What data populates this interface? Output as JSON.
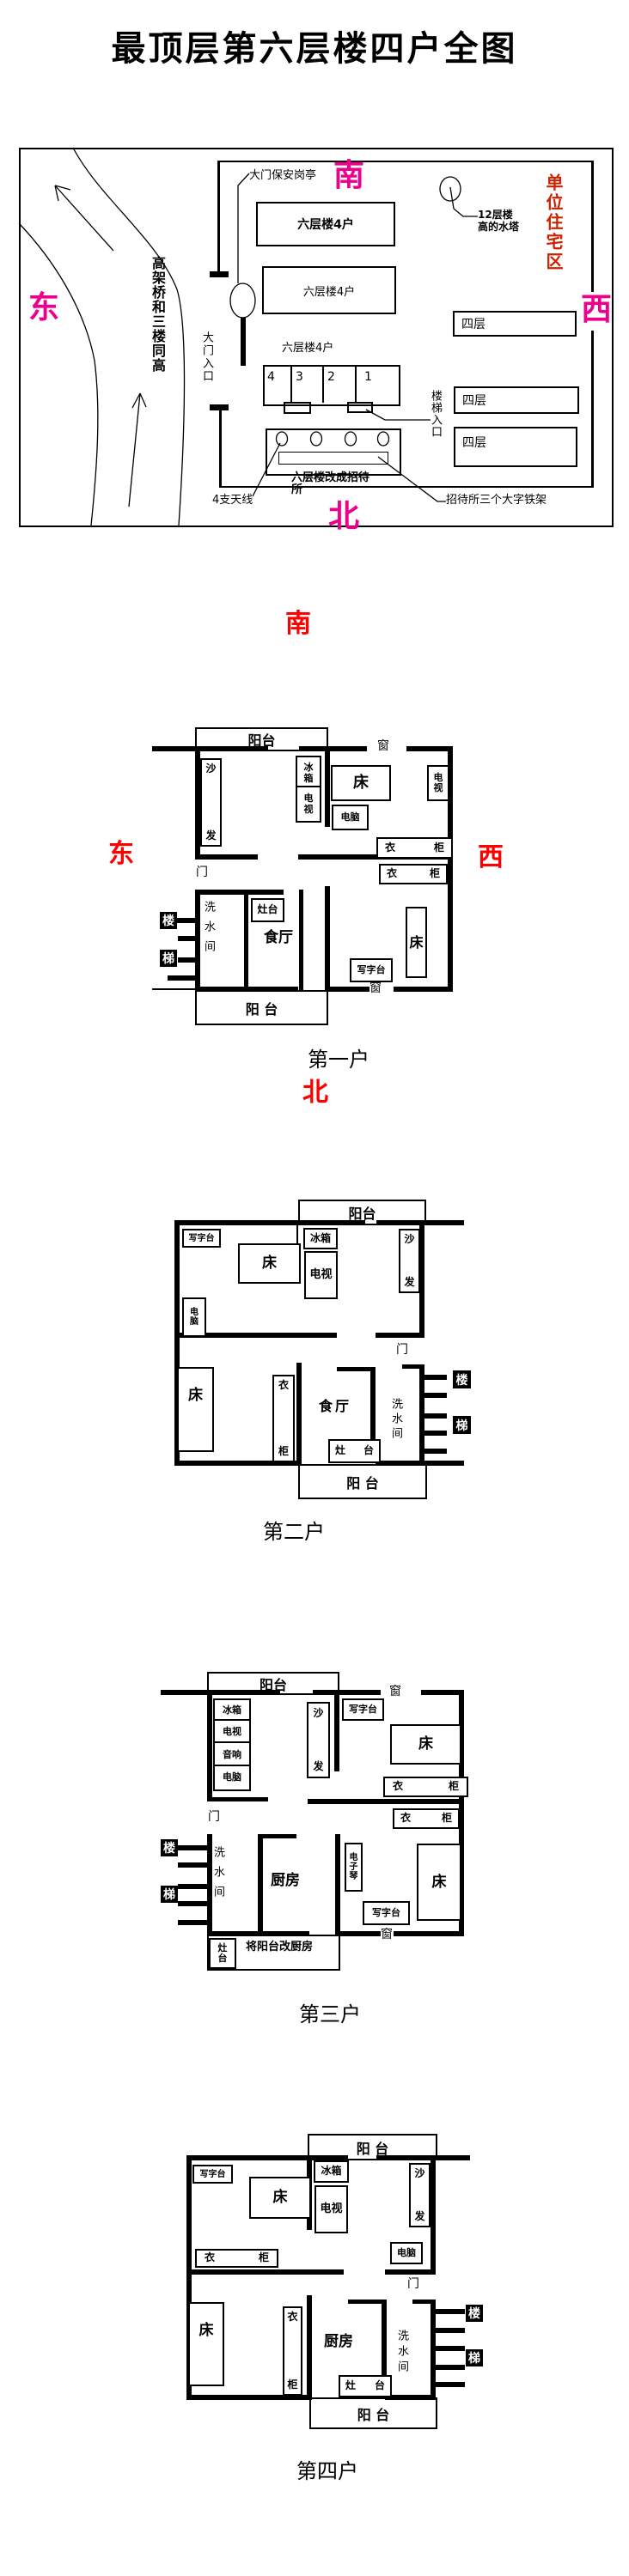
{
  "title": "最顶层第六层楼四户全图",
  "colors": {
    "map_compass": "#ec008c",
    "residential_zone_red": "#cc2200",
    "plan_compass_red": "#ff0000",
    "ink": "#000000",
    "paper": "#ffffff"
  },
  "map": {
    "compass": {
      "south": "南",
      "north": "北",
      "east": "东",
      "west": "西"
    },
    "gate_booth": "大门保安岗亭",
    "water_tower": {
      "line1": "12层楼",
      "line2": "高的水塔"
    },
    "residential_zone": "单位住宅区",
    "overpass": "高架桥和三楼同高",
    "building_six": "六层楼4户",
    "unit_numbers": [
      "4",
      "3",
      "2",
      "1"
    ],
    "four_story": "四层",
    "stair_entrance": "楼梯入口",
    "gate_entrance": "大门入口",
    "hostel_lines": [
      "六层楼改成招待",
      "所"
    ],
    "antennas": "4支天线",
    "iron_frame": "招待所三个大字铁架"
  },
  "sections": {
    "first": "第一户",
    "second": "第二户",
    "third": "第三户",
    "fourth": "第四户",
    "compass": {
      "south": "南",
      "north": "北",
      "east": "东",
      "west": "西"
    }
  },
  "rooms": {
    "balcony": "阳台",
    "balcony_sp": "阳 台",
    "dining": "食厅",
    "kitchen": "厨房",
    "washroom": "洗水间",
    "door": "门",
    "window": "窗",
    "bed": "床",
    "desk": "写字台",
    "computer": "电脑",
    "fridge": "冰箱",
    "tv": "电视",
    "stereo": "音响",
    "stove": "灶台",
    "kitchen_note": "将阳台改厨房"
  },
  "chars": {
    "sofa": [
      "沙",
      "发"
    ],
    "wardrobe": [
      "衣",
      "柜"
    ],
    "fridge": [
      "冰",
      "箱"
    ],
    "tv": [
      "电",
      "视"
    ],
    "computer": [
      "电",
      "脑"
    ],
    "piano": [
      "电",
      "子",
      "琴"
    ],
    "stove": [
      "灶",
      "台"
    ],
    "stair": [
      "楼",
      "梯"
    ]
  }
}
